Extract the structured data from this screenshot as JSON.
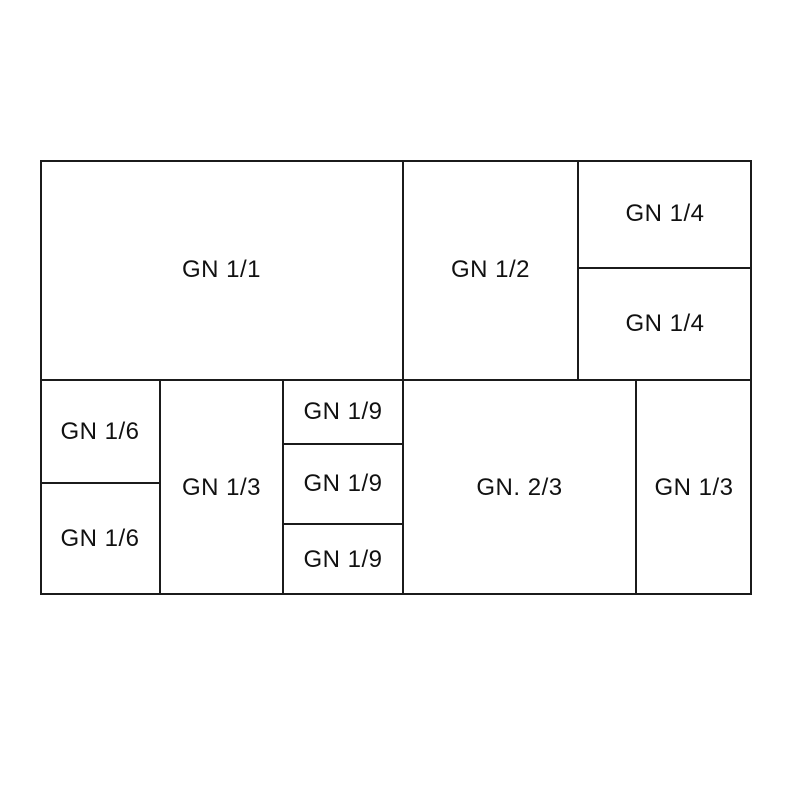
{
  "diagram": {
    "line_color": "#1b1b1b",
    "text_color": "#111111",
    "cells": [
      {
        "label": "GN 1/1"
      },
      {
        "label": "GN 1/2"
      },
      {
        "label": "GN 1/4"
      },
      {
        "label": "GN 1/4"
      },
      {
        "label": "GN 1/6"
      },
      {
        "label": "GN 1/6"
      },
      {
        "label": "GN 1/3"
      },
      {
        "label": "GN 1/9"
      },
      {
        "label": "GN 1/9"
      },
      {
        "label": "GN 1/9"
      },
      {
        "label": "GN. 2/3"
      },
      {
        "label": "GN 1/3"
      }
    ]
  }
}
